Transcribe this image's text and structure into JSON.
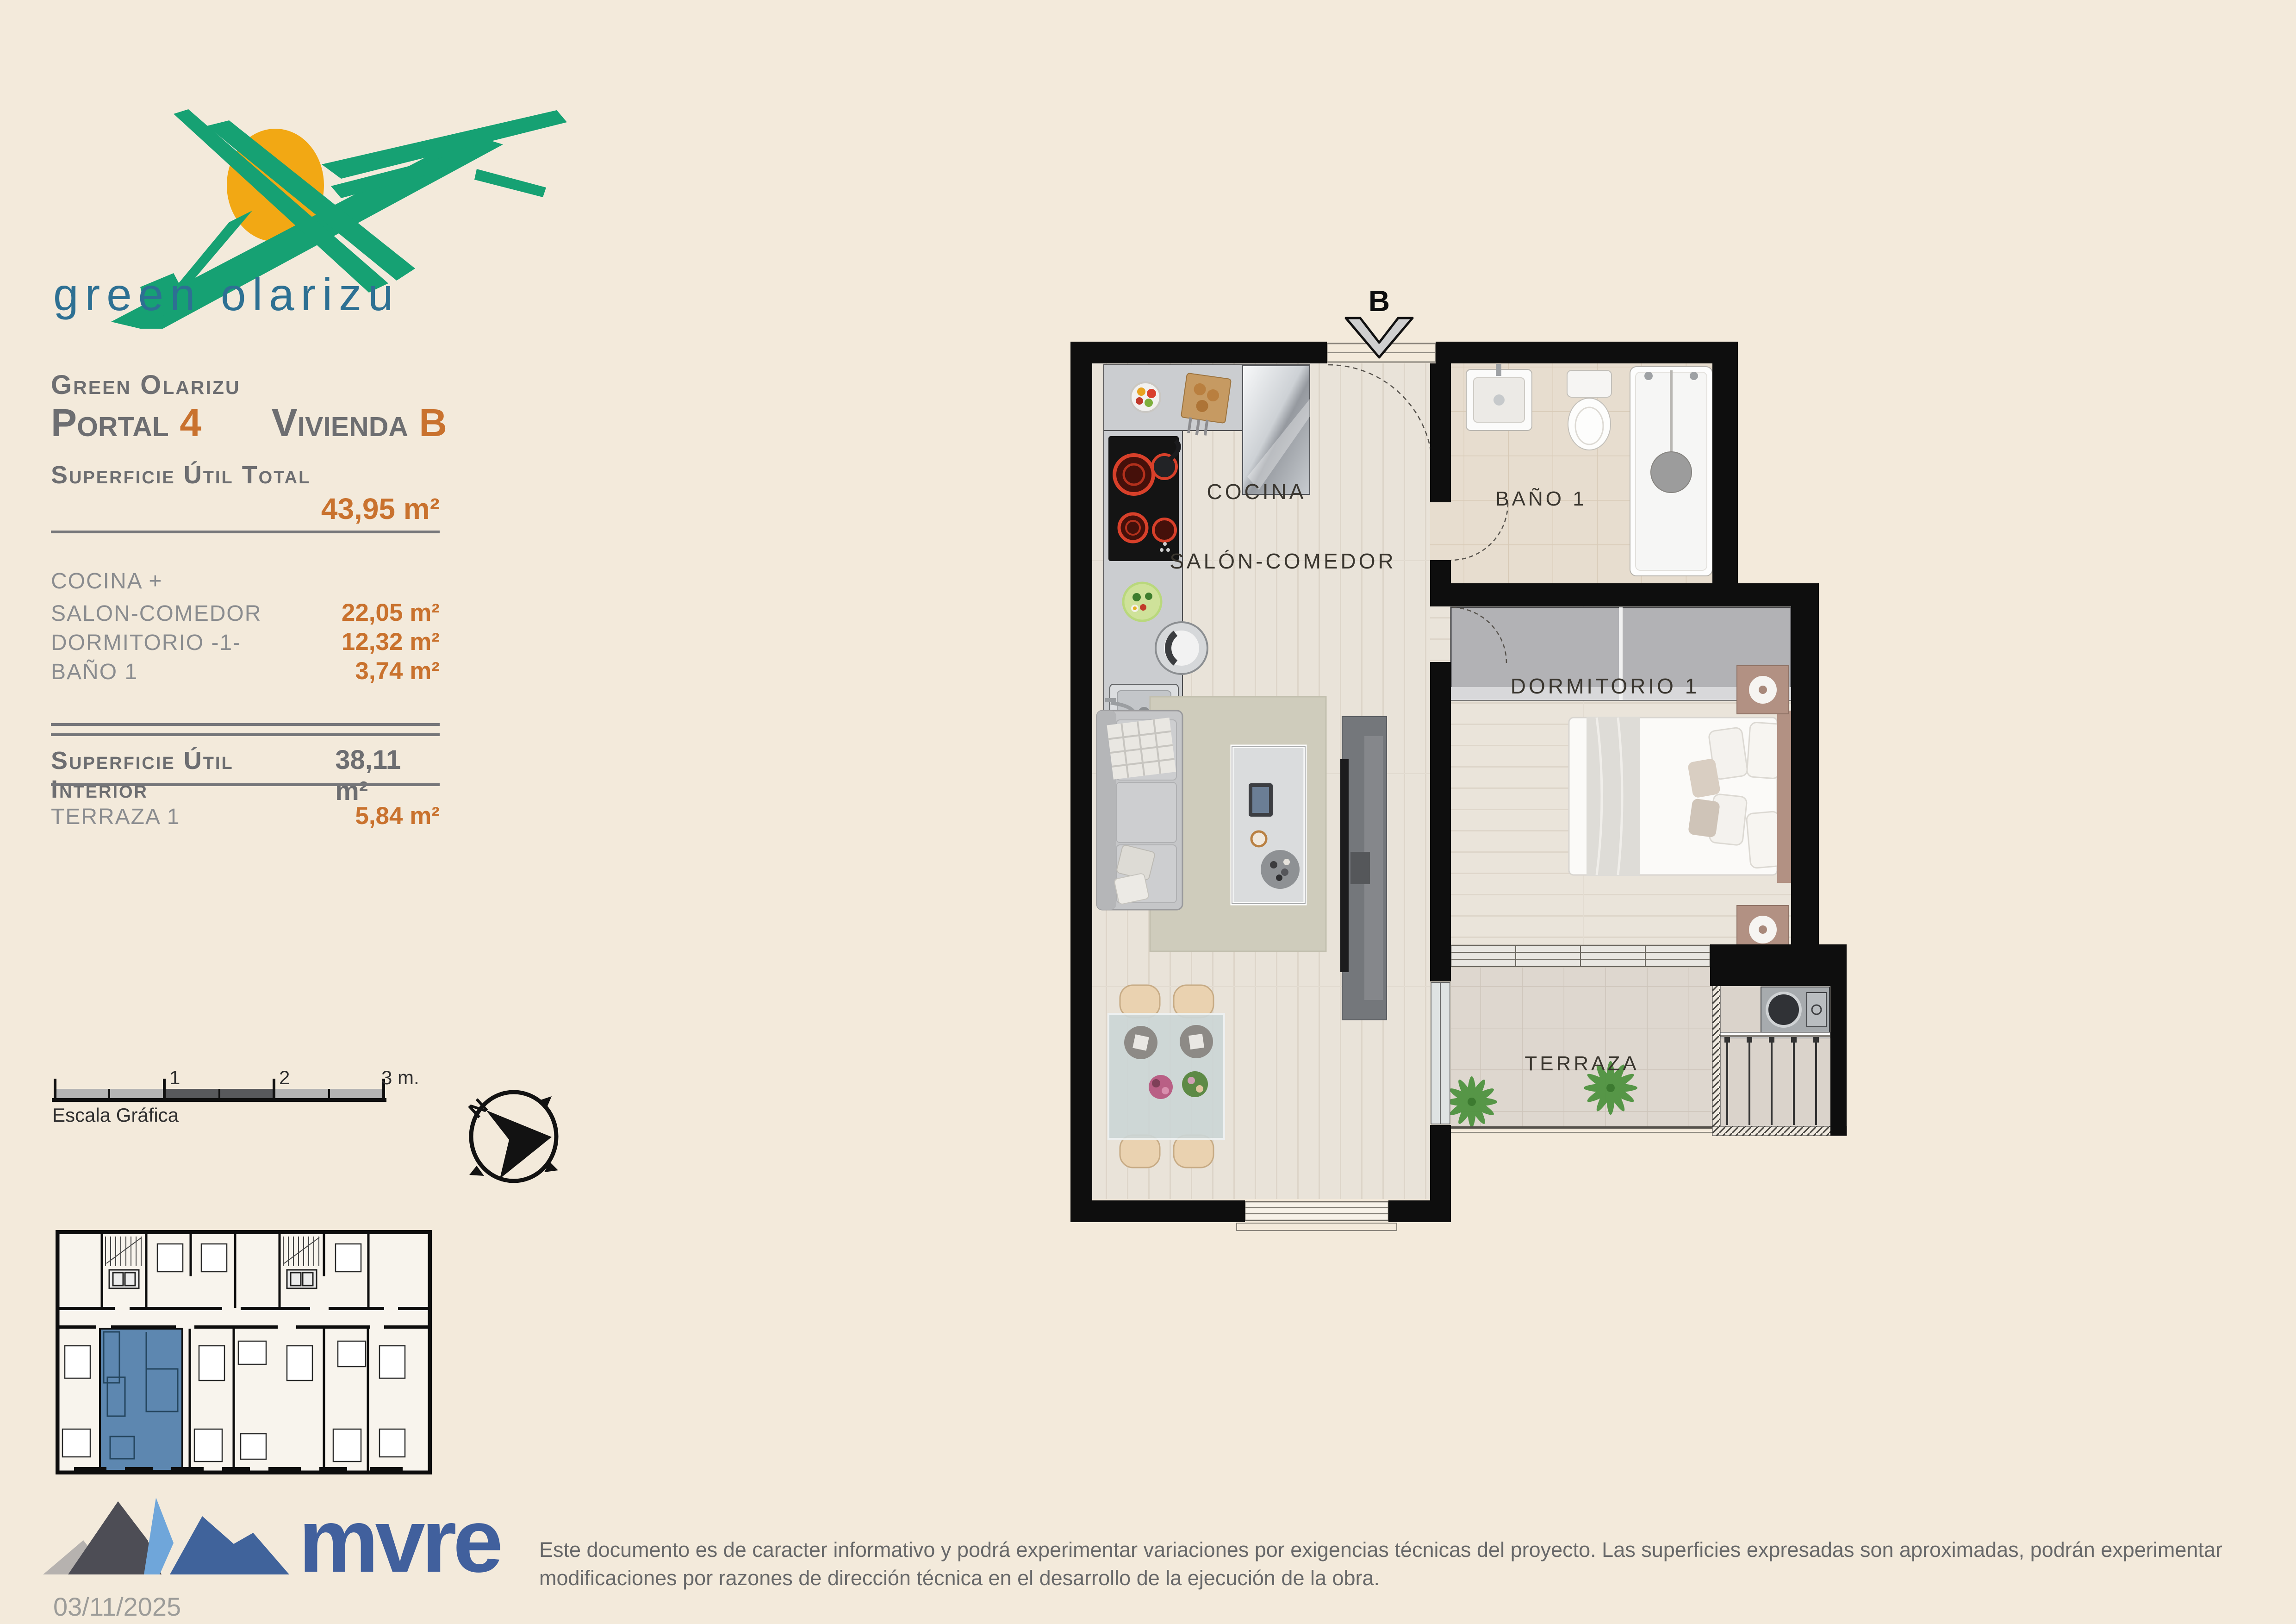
{
  "brand": {
    "logo_text": "green olarizu"
  },
  "info": {
    "project": "Green Olarizu",
    "portal_label": "Portal",
    "portal_value": "4",
    "vivienda_label": "Vivienda",
    "vivienda_value": "B",
    "total_label": "Superficie Útil Total",
    "total_value": "43,95 m²",
    "rooms": [
      {
        "label": "COCINA +",
        "value": ""
      },
      {
        "label": "SALON-COMEDOR",
        "value": "22,05 m²"
      },
      {
        "label": "DORMITORIO -1-",
        "value": "12,32 m²"
      },
      {
        "label": "BAÑO 1",
        "value": "3,74 m²"
      }
    ],
    "interior_label": "Superficie Útil Interior",
    "interior_value": "38,11 m²",
    "terrace_label": "TERRAZA 1",
    "terrace_value": "5,84 m²"
  },
  "scalebar": {
    "label": "Escala Gráfica",
    "tick1": "1",
    "tick2": "2",
    "tick3": "3 m."
  },
  "compass": {
    "north": "N"
  },
  "plan": {
    "unit_letter": "B",
    "room_cocina": "COCINA",
    "room_salon": "SALÓN-COMEDOR",
    "room_bano": "BAÑO 1",
    "room_dormitorio": "DORMITORIO 1",
    "room_terraza": "TERRAZA"
  },
  "footer": {
    "brand_name": "mvre",
    "date": "03/11/2025",
    "disclaimer": "Este documento es de caracter informativo y podrá experimentar variaciones por exigencias técnicas del proyecto. Las superficies expresadas son aproximadas, podrán experimentar modificaciones por razones de dirección técnica en el desarrollo de la ejecución de la obra."
  },
  "colors": {
    "background": "#f3eadb",
    "accent_orange": "#c9722e",
    "text_gray": "#6d6e71",
    "logo_green": "#16a173",
    "logo_sun": "#f2a814",
    "logo_teal_text": "#2d7093",
    "mvre_blue": "#41609d",
    "keyplan_highlight": "#5d87b0",
    "wall_black": "#0e0e0e"
  }
}
